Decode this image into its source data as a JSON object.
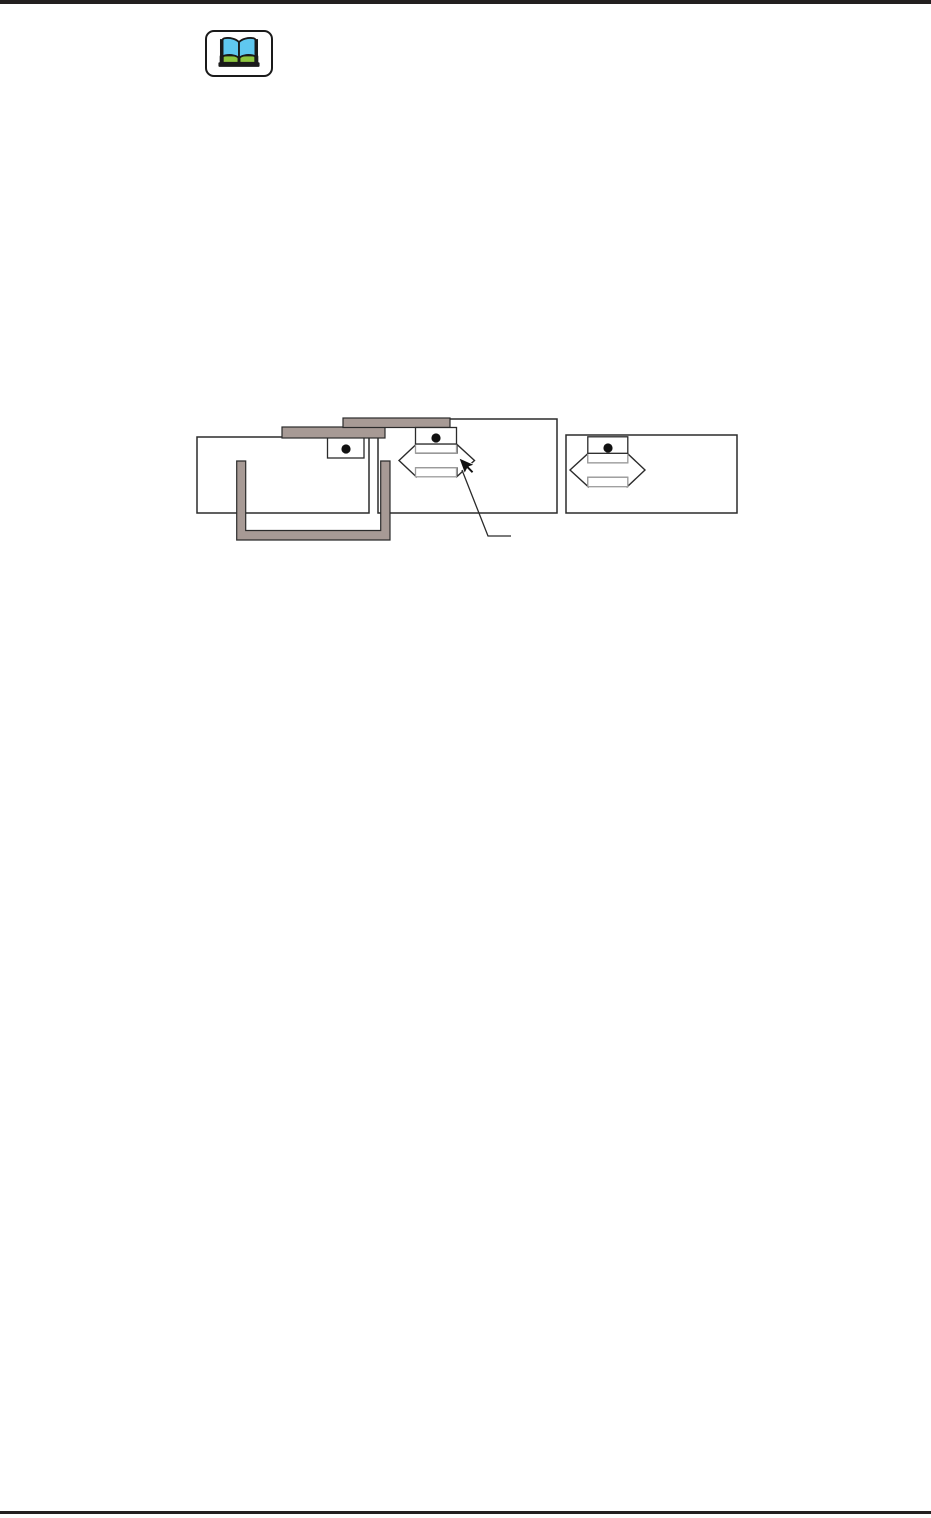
{
  "page": {
    "type": "blank manual page with figure",
    "background": "#ffffff",
    "rule_color": "#231f20"
  },
  "note_icon": {
    "name": "open-book-icon",
    "frame_fill": "#ffffff",
    "frame_stroke": "#1a1a1a",
    "outline": "#1a1a1a",
    "page_fill": "#5fc8f0",
    "base_fill": "#8cc63f"
  },
  "figure": {
    "outline": "#2b2b2b",
    "panel_fill": "#ffffff",
    "media_fill": "#a79a95",
    "guide_stroke": "#9c9c9c",
    "knob_dot": "#111111",
    "arrow_fill": "#ffffff",
    "cursor_fill": "#111111",
    "icon_names": [
      "double-headed-arrow-icon",
      "mouse-cursor-icon",
      "slider-knob-dot",
      "u-bracket-media-strip"
    ]
  }
}
